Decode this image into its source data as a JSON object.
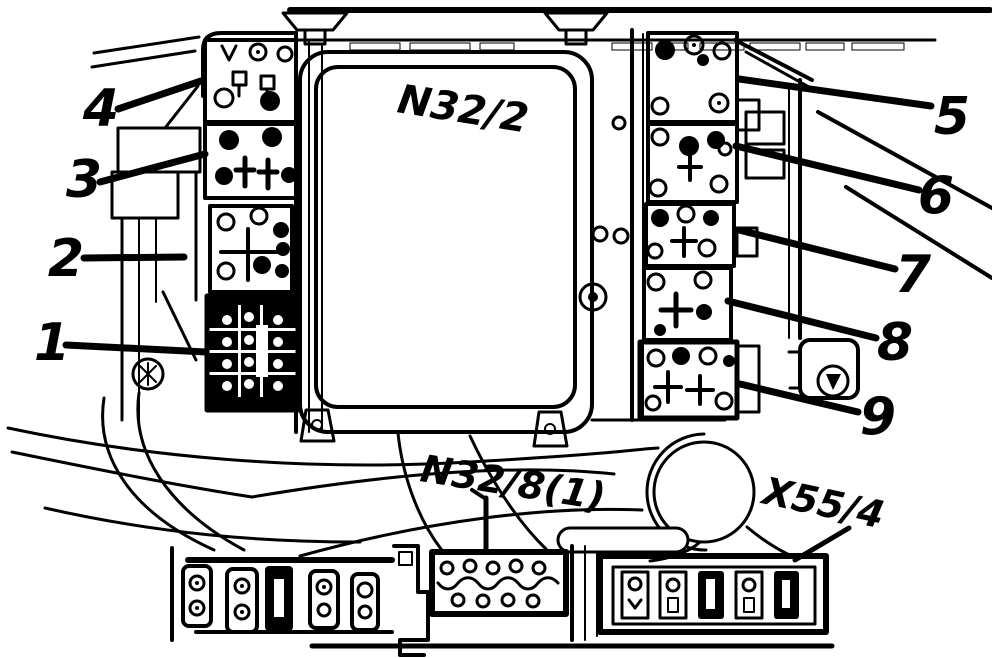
{
  "diagram": {
    "type": "technical-illustration",
    "colors": {
      "ink": "#000000",
      "background": "#ffffff"
    },
    "labels": {
      "module": "N32/2",
      "bottom_connector": "N32/8(1)",
      "terminal_strip": "X55/4"
    },
    "callouts": [
      {
        "label": "1"
      },
      {
        "label": "2"
      },
      {
        "label": "3"
      },
      {
        "label": "4"
      },
      {
        "label": "5"
      },
      {
        "label": "6"
      },
      {
        "label": "7"
      },
      {
        "label": "8"
      },
      {
        "label": "9"
      }
    ]
  }
}
